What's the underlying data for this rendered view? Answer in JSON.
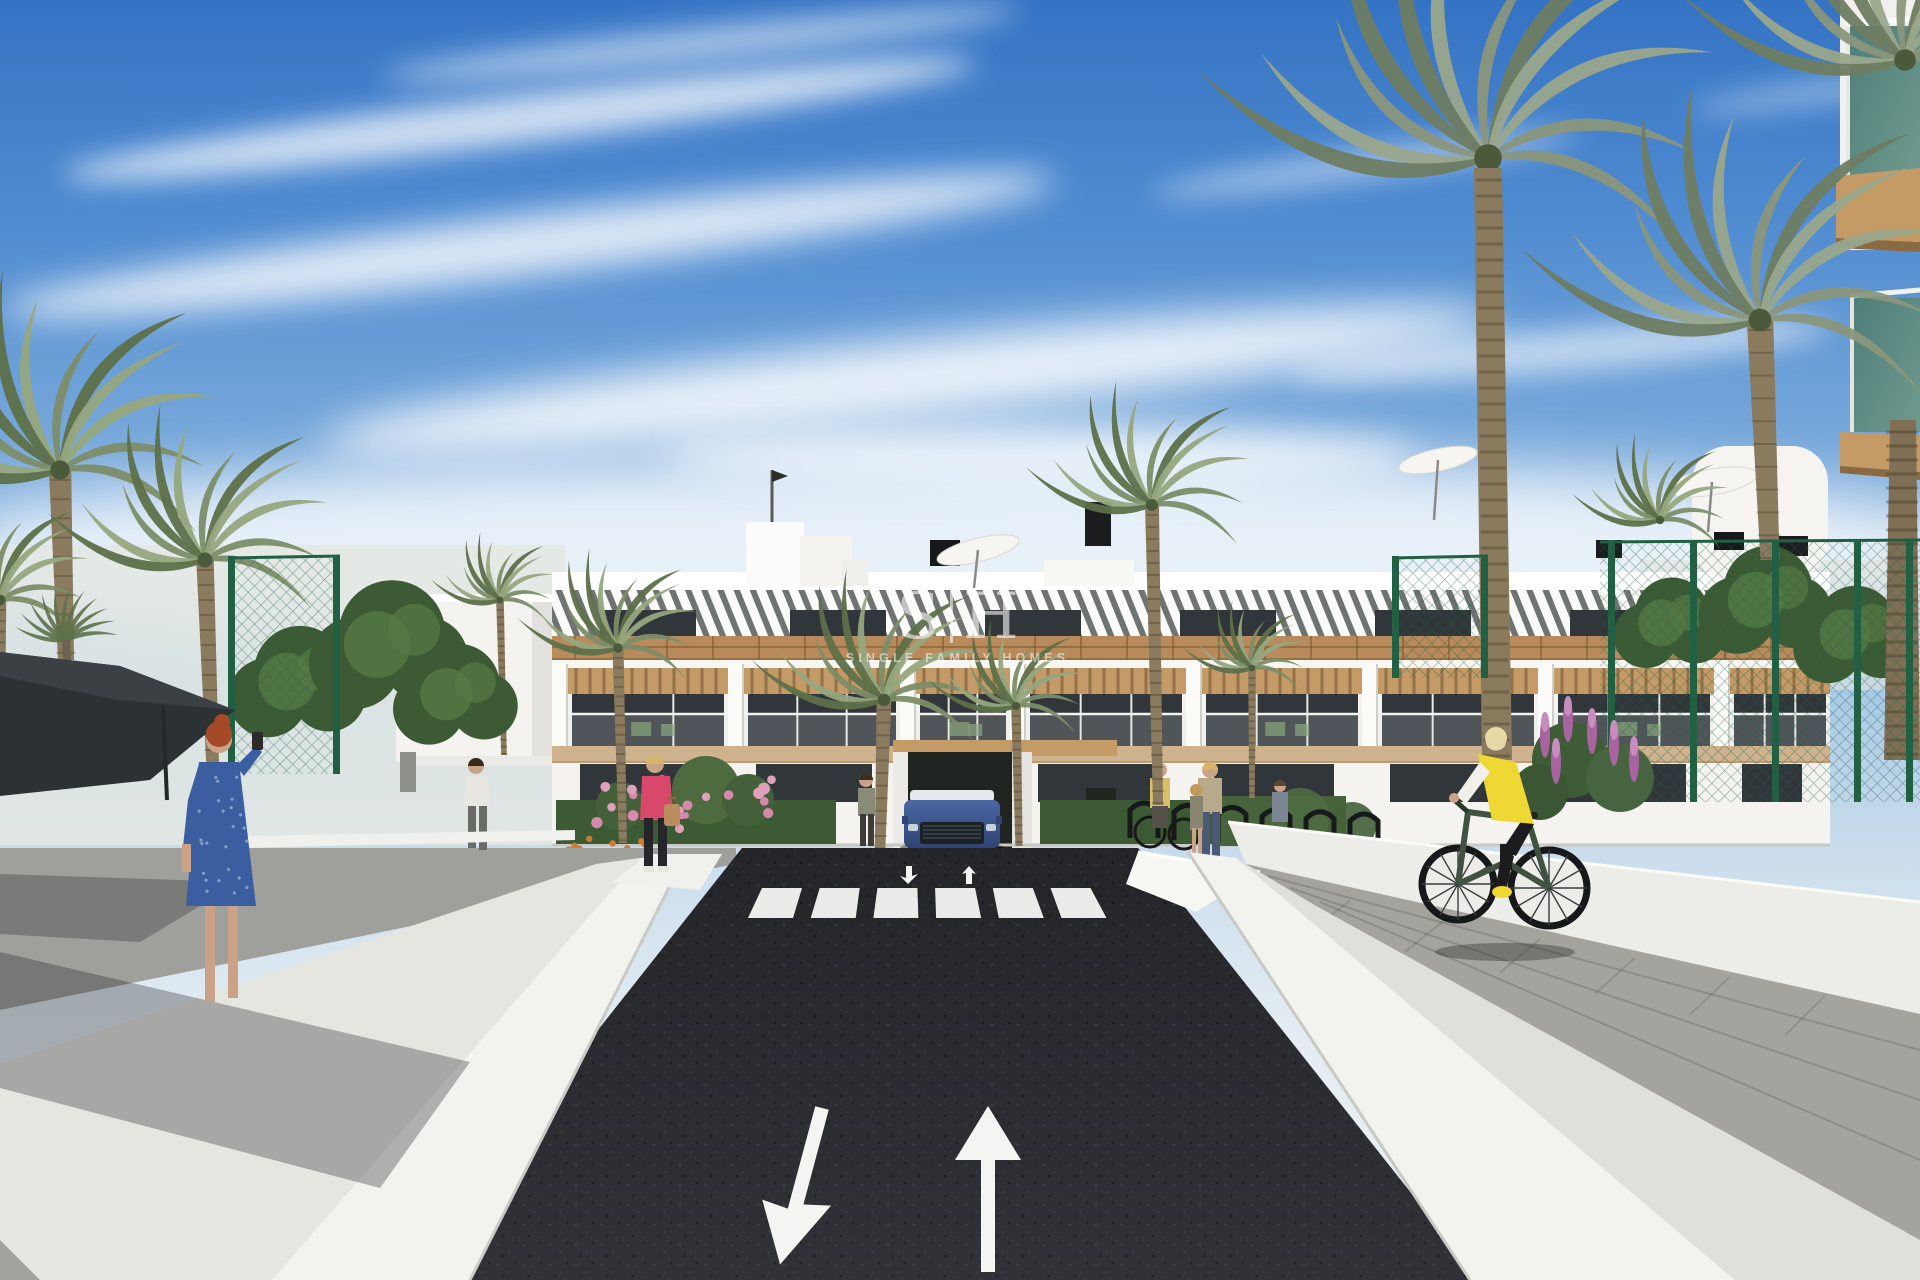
{
  "meta": {
    "title": "Residential complex exterior – architectural 3D render",
    "type": "architectural-visualization"
  },
  "watermark": {
    "logo_left": "S",
    "logo_right": "H",
    "tagline": "SINGLE FAMILY HOMES"
  },
  "road_markings": {
    "crosswalk_stripes": 6,
    "lane_arrows": [
      "down-left",
      "up"
    ],
    "small_arrows": [
      "down",
      "up"
    ]
  },
  "scene": {
    "description": "Modern white three-storey apartment building with wood-slat accents and rooftop terraces, palm trees, green mesh fences, landscaped planters, a dark asphalt two-way driveway with painted lane arrows and zebra crosswalk, pedestrians, a cyclist in a yellow vest and a blue SUV at the entrance",
    "elements": [
      "sky-with-clouds",
      "apartment-building",
      "rooftop-umbrella",
      "rooftop-ac-unit",
      "flag-pole",
      "palm-tree",
      "bushy-tree",
      "green-mesh-fence",
      "shade-sail",
      "white-perimeter-wall",
      "flower-planter",
      "bike-rack",
      "blue-suv",
      "asphalt-driveway",
      "zebra-crosswalk",
      "lane-arrow",
      "pedestrian",
      "cyclist",
      "paver-sidewalk",
      "developer-watermark"
    ]
  },
  "palette": {
    "building_white": "#f4f3f0",
    "building_shade": "#e2e1dd",
    "pergola_gap": "#6f7473",
    "slat_white": "#fafaf8",
    "wood": "#b98b5c",
    "wood_dark": "#96703f",
    "wood_pale": "#cfb28e",
    "soffit_tan": "#c49a66",
    "window_dark": "#31363a",
    "glass_teal": "#4e7d78",
    "glass_teal_light": "#6f9a8e",
    "asphalt": "#232529",
    "asphalt_light": "#303237",
    "marking_white": "#f4f4f2",
    "wall_white": "#f2f2ee",
    "wall_shade": "#e0e0db",
    "paver_gray": "#a5a39e",
    "walkway_gray": "#9fa09b",
    "fence_green": "#226044",
    "foliage_dark": "#3c5a33",
    "foliage_light": "#557a45",
    "palm_green": "#7c8d68",
    "palm_light": "#96a67e",
    "palm_dark": "#5d7049",
    "trunk_brown": "#8a7a5e",
    "flower_pink": "#d488ab",
    "flower_purple": "#a864a0",
    "flower_orange": "#cd7a33",
    "car_blue": "#4a67a4",
    "car_blue_dark": "#2e4474",
    "vest_yellow": "#f0d834",
    "jacket_pink": "#d8486a",
    "dress_blue": "#3b5ea0",
    "skin": "#caa287",
    "hair_red": "#a44a28",
    "sail_dark": "#2c3134",
    "haze": "#e3e7e3"
  }
}
